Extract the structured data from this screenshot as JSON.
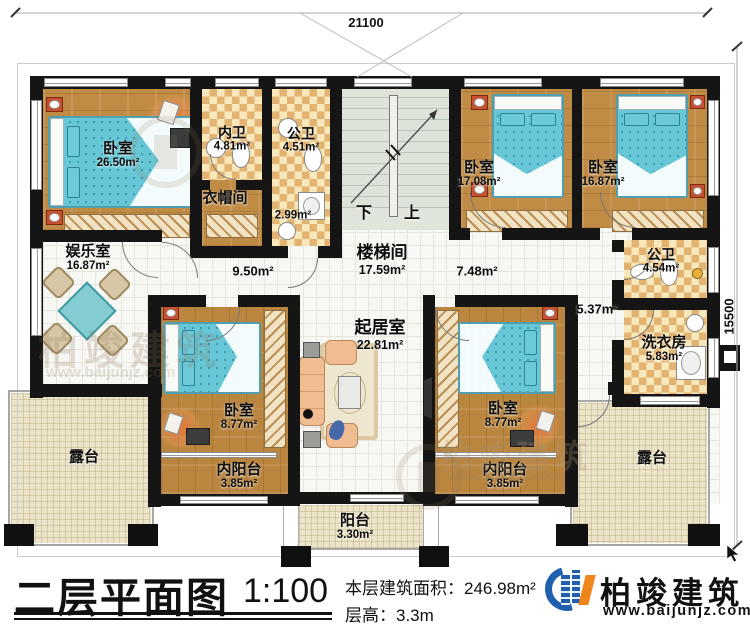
{
  "dimensions": {
    "top": "21100",
    "right": "15500"
  },
  "rooms": {
    "bedroom_tl": {
      "name": "卧室",
      "area": "26.50m²"
    },
    "inner_bath": {
      "name": "内卫",
      "area": "4.81m²"
    },
    "public_bath_top": {
      "name": "公卫",
      "area": "4.51m²"
    },
    "cloakroom": {
      "name": "衣帽间",
      "area": "2.99m²"
    },
    "entertainment": {
      "name": "娱乐室",
      "area": "16.87m²"
    },
    "stairwell": {
      "name": "楼梯间",
      "area": "17.59m²"
    },
    "stair_down": "下",
    "stair_up": "上",
    "bedroom_tc": {
      "name": "卧室",
      "area": "17.08m²"
    },
    "bedroom_tr": {
      "name": "卧室",
      "area": "16.87m²"
    },
    "public_bath_right": {
      "name": "公卫",
      "area": "4.54m²"
    },
    "laundry": {
      "name": "洗衣房",
      "area": "5.83m²"
    },
    "hall_left": "9.50m²",
    "hall_right": "7.48m²",
    "hall_small": "5.37m²",
    "living": {
      "name": "起居室",
      "area": "22.81m²"
    },
    "bedroom_bl": {
      "name": "卧室",
      "area": "8.77m²"
    },
    "bedroom_br": {
      "name": "卧室",
      "area": "8.77m²"
    },
    "inner_balcony_left": {
      "name": "内阳台",
      "area": "3.85m²"
    },
    "inner_balcony_right": {
      "name": "内阳台",
      "area": "3.85m²"
    },
    "balcony": {
      "name": "阳台",
      "area": "3.30m²"
    },
    "terrace_left": {
      "name": "露台"
    },
    "terrace_right": {
      "name": "露台"
    }
  },
  "title_block": {
    "title": "二层平面图",
    "scale": "1:100",
    "area_label": "本层建筑面积：",
    "area_value": "246.98m²",
    "floor_height_label": "层高：",
    "floor_height_value": "3.3m"
  },
  "brand": {
    "name": "柏竣建筑",
    "website": "www.baijunjz.com"
  },
  "watermark": {
    "text": "柏竣建筑",
    "url": "www.baijunjz.com"
  },
  "colors": {
    "wall": "#151515",
    "wood": "#bf8b45",
    "checker_light": "#f8e8bc",
    "checker_dark": "#e2b371",
    "stair": "#dde3d8",
    "bed": "#67c7d7",
    "furniture_red": "#c6502f",
    "brand_blue": "#1f5fae",
    "brand_orange": "#f08519"
  }
}
